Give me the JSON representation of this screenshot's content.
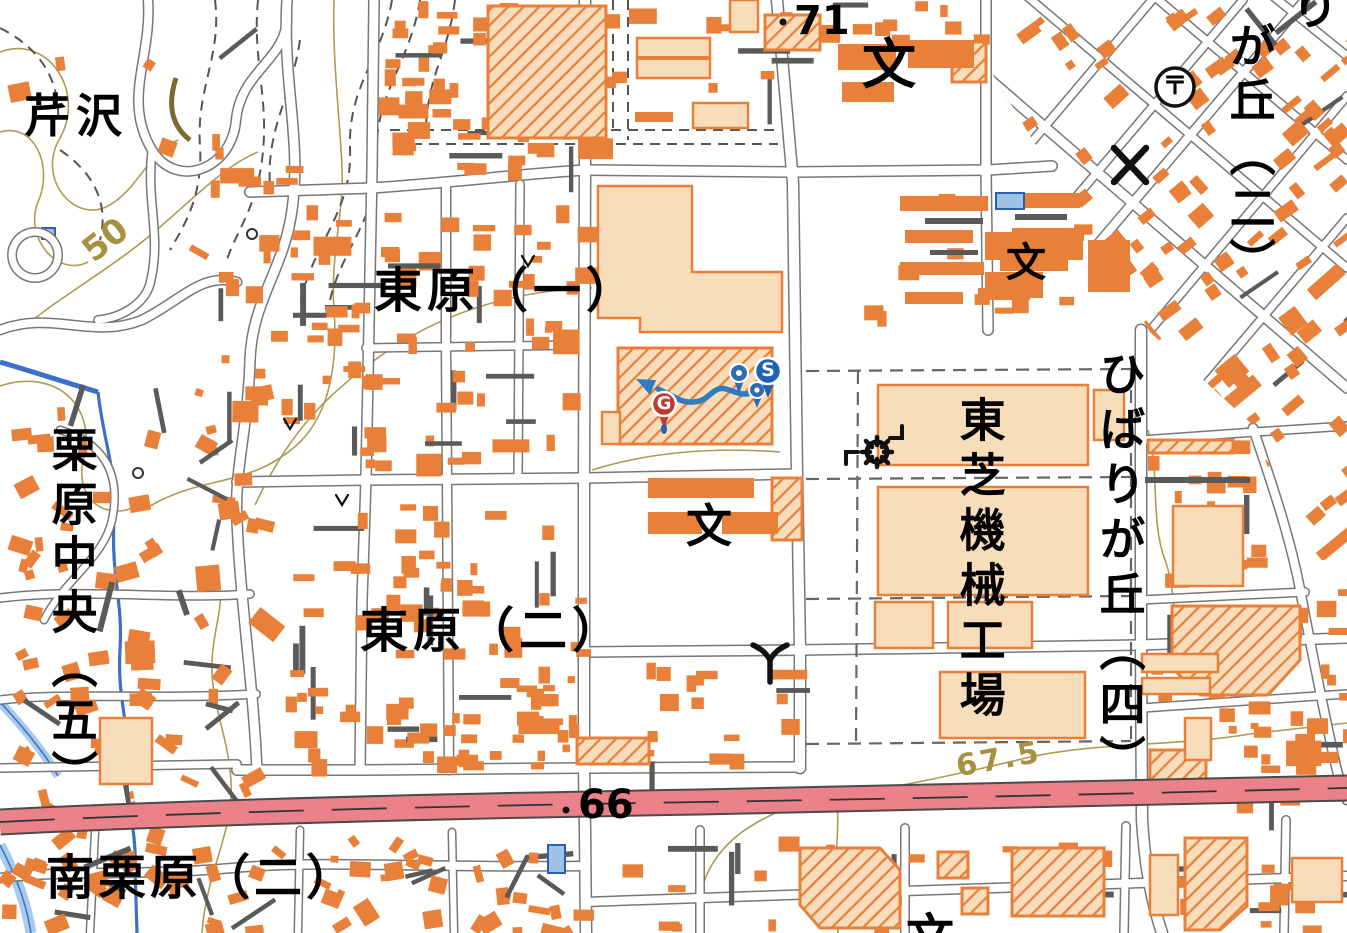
{
  "map": {
    "title": "Japanese topographic map (GSI style) — Higashihara / Hibarigaoka area",
    "place_labels": {
      "serizawa": "芹沢",
      "higashihara_1": "東原（一）",
      "higashihara_2": "東原（二）",
      "kurihara_chuo_5": "栗原中央（五）",
      "minami_kurihara_2": "南栗原（二）",
      "toshiba_factory": "東芝機械工場",
      "hibarigaoka_4": "ひばりが丘（四）",
      "gaoka_2": "が丘（二）",
      "ri_partial": "り"
    },
    "elevation_labels": {
      "spot_71": "71",
      "spot_66": "66",
      "contour_50": "50",
      "contour_67_5": "67.5"
    },
    "symbols": {
      "school_glyph": "文",
      "post_office_glyph": "〒"
    },
    "route": {
      "start_label": "S",
      "goal_label": "G"
    },
    "colors": {
      "background": "#FFFFFF",
      "building_small": "#E8803A",
      "building_large": "#F8DDBB",
      "building_dark": "#5A5A5A",
      "road_casing": "#777777",
      "road_fill": "#FFFFFF",
      "highway": "#EC8289",
      "contour": "#AE9B52",
      "water": "#3D6EC8",
      "water_light": "#A8CBEA",
      "route_line": "#2E7CC4",
      "marker_start": "#1E63B5",
      "marker_goal": "#C03A33",
      "symbol_black": "#111111"
    }
  }
}
